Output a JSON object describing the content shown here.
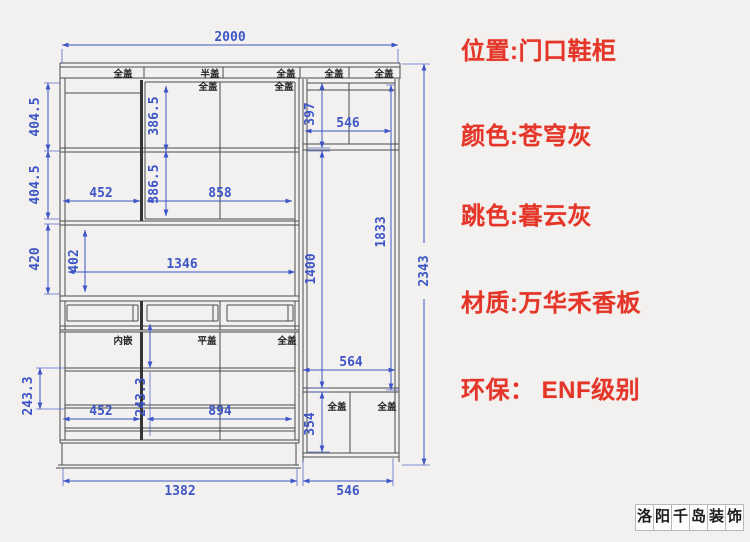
{
  "colors": {
    "dimension_blue": "#3e55c6",
    "structure_line": "#4a4a4a",
    "note_red": "#e43528",
    "background": "#f3f1ef"
  },
  "dims": {
    "total_width": "2000",
    "total_height": "2343",
    "left_top_h": "404.5",
    "left_mid_h": "404.5",
    "niche_outer_h": "420",
    "niche_inner_h": "402",
    "upper_door_h_top": "386.5",
    "upper_door_h_bottom": "386.5",
    "upper_door_w_left": "452",
    "upper_door_w_right": "858",
    "niche_w": "1346",
    "right_top_cabinet_h": "397",
    "right_top_cabinet_w": "546",
    "right_mid_h": "1400",
    "right_open_h": "1833",
    "right_lower_inner_w": "564",
    "drawer_h_left": "243.3",
    "drawer_h_mid": "243.3",
    "drawer_w_left": "452",
    "drawer_w_right": "894",
    "right_bottom_cabinet_h": "354",
    "base_w_left": "1382",
    "base_w_right": "546"
  },
  "cover_labels": {
    "top_1": "全盖",
    "top_2": "半盖",
    "top_3": "全盖",
    "top_4": "全盖",
    "top_5": "全盖",
    "inner_1": "全盖",
    "inner_2": "全盖",
    "lower_1": "内嵌",
    "lower_2": "平盖",
    "lower_3": "全盖",
    "bottom_right_1": "全盖",
    "bottom_right_2": "全盖"
  },
  "notes": {
    "location": "位置:门口鞋柜",
    "color": "颜色:苍穹灰",
    "accent_color": "跳色:暮云灰",
    "material": "材质:万华禾香板",
    "eco": "环保： ENF级别"
  },
  "watermark": {
    "char_1": "洛",
    "char_2": "阳",
    "char_3": "千",
    "char_4": "岛",
    "char_5": "装",
    "char_6": "饰"
  }
}
